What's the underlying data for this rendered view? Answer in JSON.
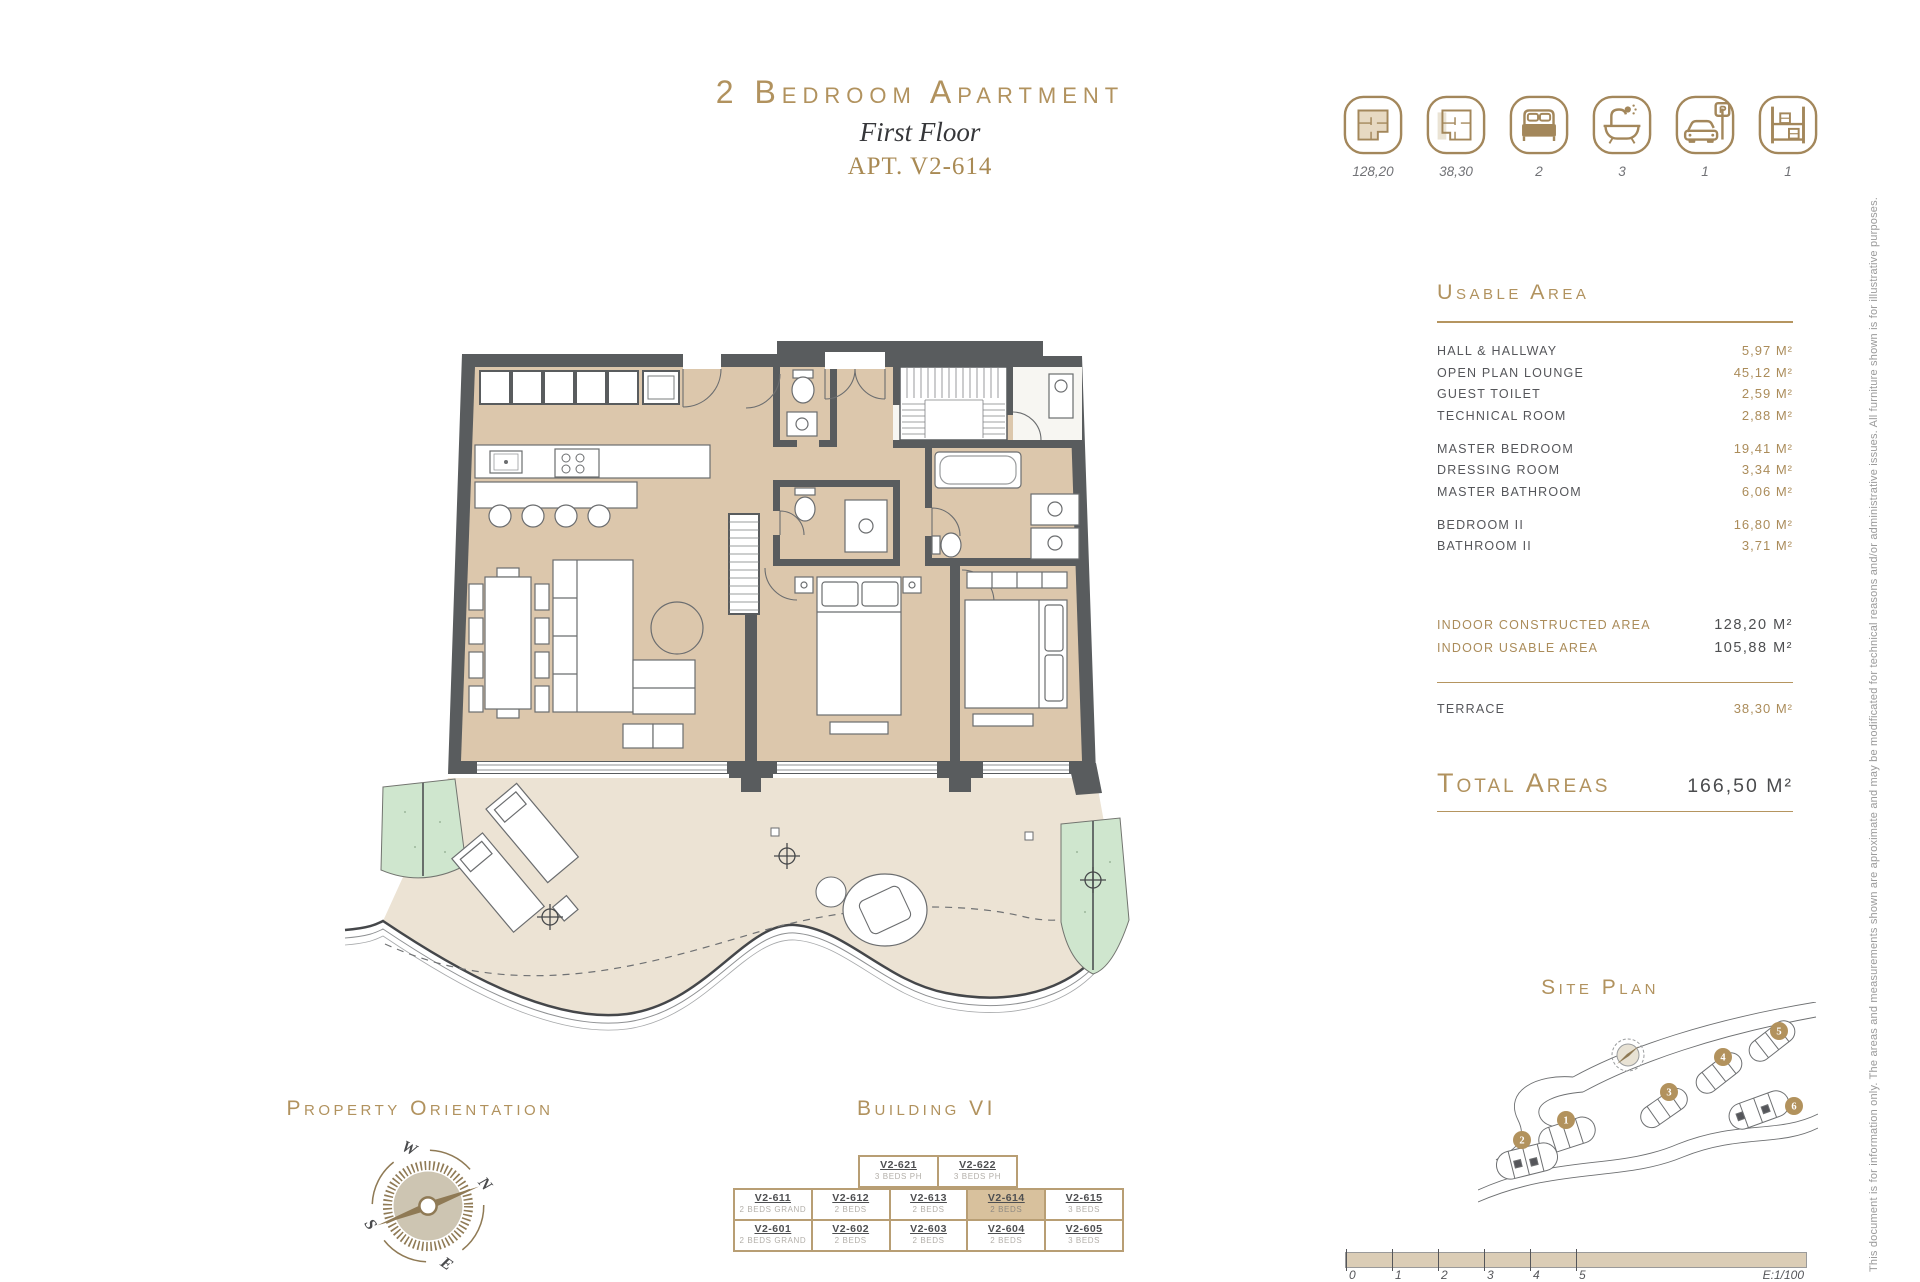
{
  "title": {
    "main": "2 Bedroom Apartment",
    "subtitle": "First Floor",
    "apt": "APT. V2-614"
  },
  "features": [
    {
      "icon": "constructed-area-plan-icon",
      "value": "128,20"
    },
    {
      "icon": "terrace-area-plan-icon",
      "value": "38,30"
    },
    {
      "icon": "bedrooms-icon",
      "value": "2"
    },
    {
      "icon": "bathrooms-icon",
      "value": "3"
    },
    {
      "icon": "parking-icon",
      "value": "1"
    },
    {
      "icon": "storage-icon",
      "value": "1"
    }
  ],
  "usable_area": {
    "heading": "Usable Area",
    "groups": [
      {
        "rows": [
          {
            "label": "HALL & HALLWAY",
            "value": "5,97 M²"
          },
          {
            "label": "OPEN PLAN LOUNGE",
            "value": "45,12 M²"
          },
          {
            "label": "GUEST TOILET",
            "value": "2,59 M²"
          },
          {
            "label": "TECHNICAL ROOM",
            "value": "2,88 M²"
          }
        ]
      },
      {
        "rows": [
          {
            "label": "MASTER BEDROOM",
            "value": "19,41 M²"
          },
          {
            "label": "DRESSING ROOM",
            "value": "3,34 M²"
          },
          {
            "label": "MASTER BATHROOM",
            "value": "6,06 M²"
          }
        ]
      },
      {
        "rows": [
          {
            "label": "BEDROOM II",
            "value": "16,80 M²"
          },
          {
            "label": "BATHROOM II",
            "value": "3,71 M²"
          }
        ]
      }
    ],
    "summary": [
      {
        "label": "INDOOR CONSTRUCTED AREA",
        "value": "128,20 M²"
      },
      {
        "label": "INDOOR USABLE AREA",
        "value": "105,88 M²"
      }
    ],
    "terrace": {
      "label": "TERRACE",
      "value": "38,30 M²"
    },
    "total": {
      "label": "Total Areas",
      "value": "166,50 M²"
    }
  },
  "property_orientation": {
    "heading": "Property Orientation",
    "cardinal": {
      "n": "N",
      "s": "S",
      "e": "E",
      "w": "W"
    }
  },
  "building": {
    "heading": "Building VI",
    "penthouse_row": [
      {
        "unit": "V2-621",
        "type": "3 BEDS PH"
      },
      {
        "unit": "V2-622",
        "type": "3 BEDS PH"
      }
    ],
    "row1": [
      {
        "unit": "V2-611",
        "type": "2 BEDS GRAND"
      },
      {
        "unit": "V2-612",
        "type": "2 BEDS"
      },
      {
        "unit": "V2-613",
        "type": "2 BEDS"
      },
      {
        "unit": "V2-614",
        "type": "2 BEDS"
      },
      {
        "unit": "V2-615",
        "type": "3 BEDS"
      }
    ],
    "row2": [
      {
        "unit": "V2-601",
        "type": "2 BEDS GRAND"
      },
      {
        "unit": "V2-602",
        "type": "2 BEDS"
      },
      {
        "unit": "V2-603",
        "type": "2 BEDS"
      },
      {
        "unit": "V2-604",
        "type": "2 BEDS"
      },
      {
        "unit": "V2-605",
        "type": "3 BEDS"
      }
    ],
    "highlighted_unit": "V2-614"
  },
  "site_plan": {
    "heading": "Site Plan",
    "markers": [
      "1",
      "2",
      "3",
      "4",
      "5",
      "6"
    ]
  },
  "scale_bar": {
    "ticks": [
      "0",
      "1",
      "2",
      "3",
      "4",
      "5"
    ],
    "label": "E:1/100"
  },
  "disclaimer": "This document is for information only. The areas and measurements shown are aproximate and may be modificated for technical reasons and/or administrative issues. All furniture shown is for illustrative purposes.",
  "colors": {
    "accent": "#b1925e",
    "wall": "#595c5e",
    "floor": "#dcc7ac",
    "terrace": "#ece3d4",
    "planter": "#cfe6ce"
  }
}
